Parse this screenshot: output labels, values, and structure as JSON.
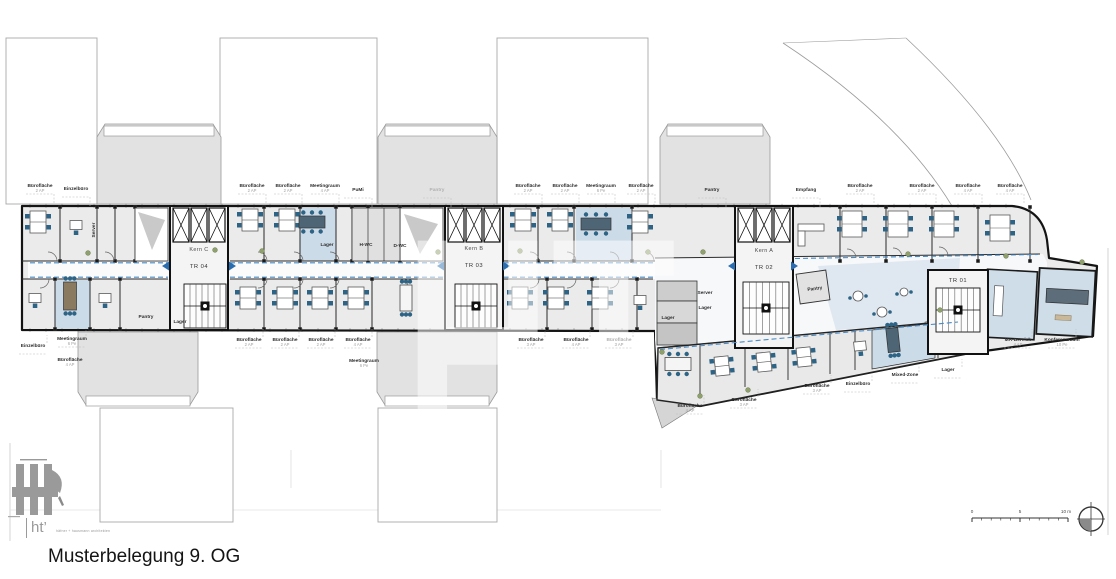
{
  "title": "Musterbelegung 9. OG",
  "watermark_text": "HT",
  "logo": {
    "mark": "ht’",
    "firm": "häfner + hausmann architekten"
  },
  "cores": [
    {
      "kern": "Kern C",
      "tr": "TR 04",
      "x": 199,
      "y": 251
    },
    {
      "kern": "Kern B",
      "tr": "TR 03",
      "x": 474,
      "y": 250
    },
    {
      "kern": "Kern A",
      "tr": "TR 02",
      "x": 764,
      "y": 252
    },
    {
      "kern": "",
      "tr": "TR 01",
      "x": 958,
      "y": 282
    }
  ],
  "room_labels": [
    {
      "t": "Bürofläche",
      "s": "2 AP",
      "x": 40,
      "y": 187,
      "d": "d"
    },
    {
      "t": "Einzelbüro",
      "s": "",
      "x": 76,
      "y": 190,
      "d": "d"
    },
    {
      "t": "Bürofläche",
      "s": "2 AP",
      "x": 252,
      "y": 187,
      "d": "d"
    },
    {
      "t": "Bürofläche",
      "s": "2 AP",
      "x": 288,
      "y": 187,
      "d": "d"
    },
    {
      "t": "Meetingraum",
      "s": "4 AP",
      "x": 325,
      "y": 187,
      "d": "d"
    },
    {
      "t": "PuMi",
      "s": "",
      "x": 358,
      "y": 191,
      "d": "d"
    },
    {
      "t": "Pantry",
      "s": "",
      "x": 437,
      "y": 191,
      "d": "d",
      "m": true
    },
    {
      "t": "Bürofläche",
      "s": "2 AP",
      "x": 528,
      "y": 187,
      "d": "d"
    },
    {
      "t": "Bürofläche",
      "s": "2 AP",
      "x": 565,
      "y": 187,
      "d": "d"
    },
    {
      "t": "Meetingraum",
      "s": "6 Pe",
      "x": 601,
      "y": 187,
      "d": "d"
    },
    {
      "t": "Bürofläche",
      "s": "2 AP",
      "x": 641,
      "y": 187,
      "d": "d"
    },
    {
      "t": "Pantry",
      "s": "",
      "x": 712,
      "y": 191,
      "d": "d"
    },
    {
      "t": "Empfang",
      "s": "",
      "x": 806,
      "y": 191,
      "d": "d"
    },
    {
      "t": "Bürofläche",
      "s": "2 AP",
      "x": 860,
      "y": 187,
      "d": "d"
    },
    {
      "t": "Bürofläche",
      "s": "2 AP",
      "x": 922,
      "y": 187,
      "d": "d"
    },
    {
      "t": "Bürofläche",
      "s": "4 AP",
      "x": 968,
      "y": 187,
      "d": "d"
    },
    {
      "t": "Bürofläche",
      "s": "4 AP",
      "x": 1010,
      "y": 187,
      "d": "d"
    },
    {
      "t": "Einzelbüro",
      "s": "",
      "x": 33,
      "y": 347,
      "d": "u"
    },
    {
      "t": "Meetingraum",
      "s": "6 Pe",
      "x": 72,
      "y": 340,
      "d": "u"
    },
    {
      "t": "Bürofläche",
      "s": "4 AP",
      "x": 70,
      "y": 361
    },
    {
      "t": "Bürofläche",
      "s": "2 AP",
      "x": 249,
      "y": 341,
      "d": "u"
    },
    {
      "t": "Bürofläche",
      "s": "2 AP",
      "x": 285,
      "y": 341,
      "d": "u"
    },
    {
      "t": "Bürofläche",
      "s": "2 AP",
      "x": 321,
      "y": 341,
      "d": "u"
    },
    {
      "t": "Bürofläche",
      "s": "4 AP",
      "x": 358,
      "y": 341,
      "d": "u"
    },
    {
      "t": "Meetingraum",
      "s": "6 Pe",
      "x": 364,
      "y": 362
    },
    {
      "t": "Bürofläche",
      "s": "3 AP",
      "x": 531,
      "y": 341,
      "d": "u"
    },
    {
      "t": "Bürofläche",
      "s": "4 AP",
      "x": 576,
      "y": 341,
      "d": "u"
    },
    {
      "t": "Bürofläche",
      "s": "3 AP",
      "x": 619,
      "y": 341,
      "m": true,
      "d": "u"
    },
    {
      "t": "Bürofläche",
      "s": "4 AP",
      "x": 690,
      "y": 407,
      "d": "u"
    },
    {
      "t": "Bürofläche",
      "s": "3 AP",
      "x": 744,
      "y": 401,
      "d": "u"
    },
    {
      "t": "Bürofläche",
      "s": "3 AP",
      "x": 817,
      "y": 387,
      "d": "u"
    },
    {
      "t": "Einzelbüro",
      "s": "",
      "x": 858,
      "y": 385,
      "d": "u"
    },
    {
      "t": "Mixed-Zone",
      "s": "",
      "x": 905,
      "y": 376,
      "d": "u"
    },
    {
      "t": "Lager",
      "s": "",
      "x": 948,
      "y": 371,
      "d": "u"
    },
    {
      "t": "MA-Bereich",
      "s": "4 AP",
      "x": 1018,
      "y": 341,
      "d": "u"
    },
    {
      "t": "Konferenzraum",
      "s": "10 Pe",
      "x": 1062,
      "y": 341,
      "d": "u"
    },
    {
      "t": "Server",
      "s": "",
      "x": 95,
      "y": 230,
      "r": -90
    },
    {
      "t": "Pantry",
      "s": "",
      "x": 146,
      "y": 318
    },
    {
      "t": "Lager",
      "s": "",
      "x": 180,
      "y": 323
    },
    {
      "t": "Lager",
      "s": "",
      "x": 327,
      "y": 246
    },
    {
      "t": "H-WC",
      "s": "",
      "x": 366,
      "y": 246
    },
    {
      "t": "D-WC",
      "s": "",
      "x": 400,
      "y": 247
    },
    {
      "t": "Server",
      "s": "",
      "x": 705,
      "y": 294
    },
    {
      "t": "Lager",
      "s": "",
      "x": 705,
      "y": 309
    },
    {
      "t": "Lager",
      "s": "",
      "x": 668,
      "y": 319
    },
    {
      "t": "Pantry",
      "s": "",
      "x": 815,
      "y": 290,
      "r": -8
    }
  ],
  "scale_bar": {
    "tick_labels": [
      "0",
      "5",
      "10 m"
    ]
  }
}
